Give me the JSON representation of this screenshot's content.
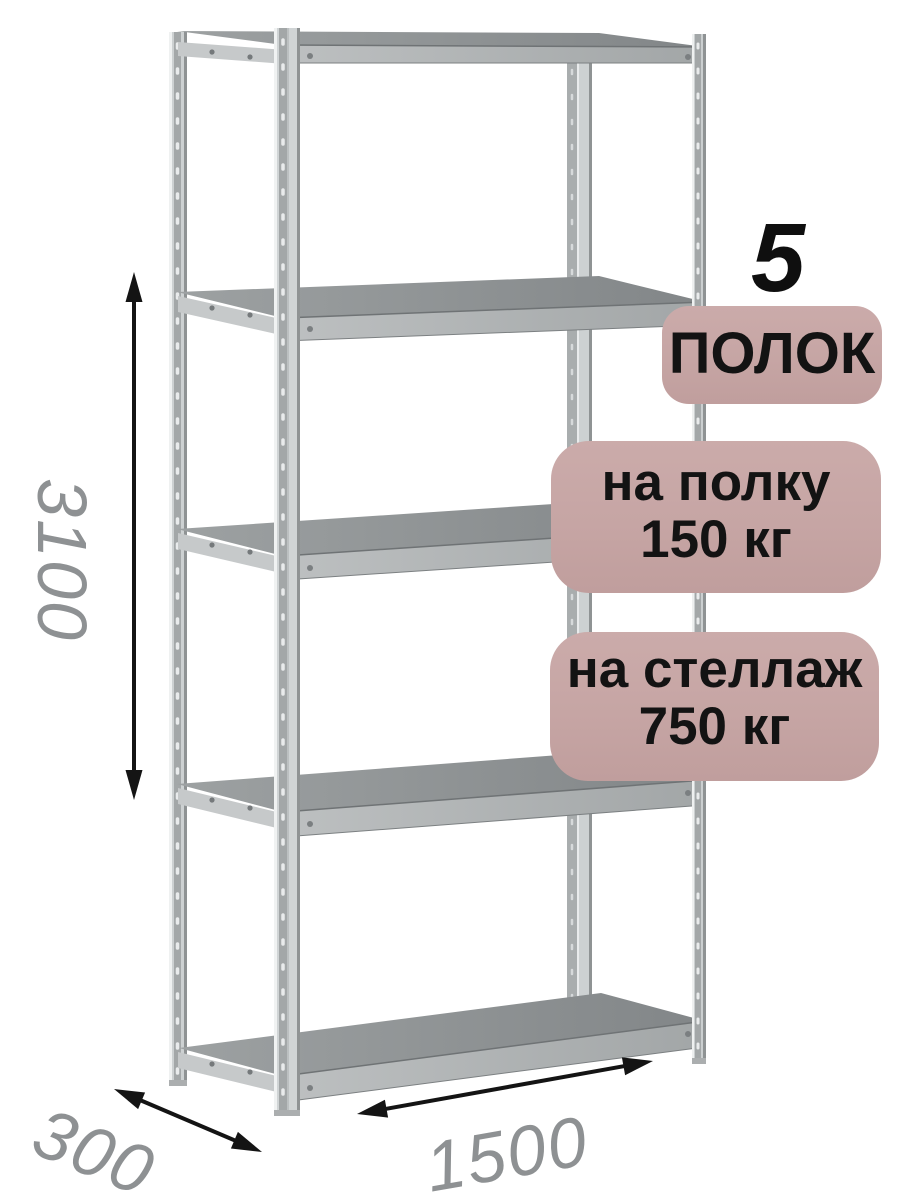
{
  "badges": {
    "shelf_count": {
      "number": "5",
      "label": "ПОЛОК"
    },
    "shelf_load": {
      "line1": "на полку",
      "line2": "150 кг"
    },
    "rack_load": {
      "line1": "на стеллаж",
      "line2": "750 кг"
    }
  },
  "dimensions": {
    "height": "3100",
    "depth": "300",
    "width": "1500"
  },
  "colors": {
    "badge_bg": "#c6a5a4",
    "badge_text": "#131313",
    "dimension_text": "#8e9193",
    "arrow": "#141414",
    "metal_light": "#cdd1d2",
    "metal_stripe": "#a3a7a8",
    "shelf_top": "#8c9091",
    "background": "#ffffff"
  },
  "illustration": {
    "subject": "metal-shelving-rack",
    "shelves_drawn": 5,
    "posts_drawn": 4
  }
}
